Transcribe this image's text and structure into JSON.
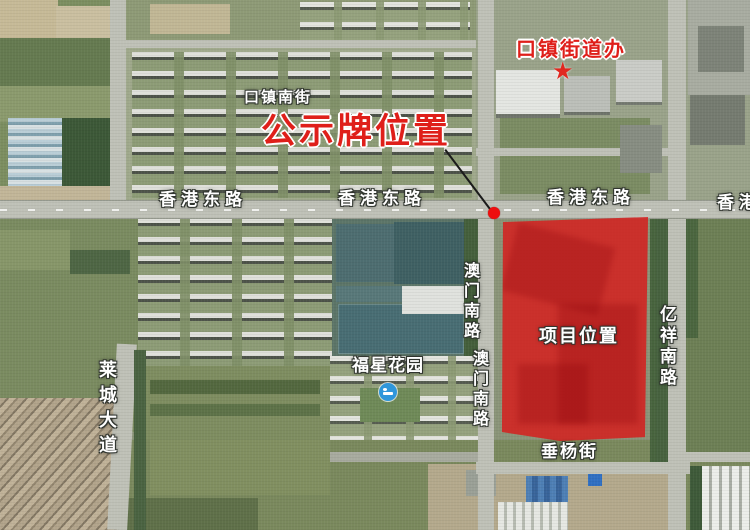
{
  "map": {
    "annotations": {
      "office": "口镇街道办",
      "notice_board": "公示牌位置",
      "project": "项目位置"
    },
    "streets": {
      "kouzhen_south": "口镇南街",
      "hk_east_left": "香港东路",
      "hk_east_center": "香港东路",
      "hk_east_right": "香港东路",
      "hk_east_edge": "香港",
      "aomen_south_upper": "澳门南路",
      "aomen_south_lower": "澳门南路",
      "yixiang_south": "亿祥南路",
      "laicheng_avenue": "莱城大道",
      "chuiyang": "垂杨街"
    },
    "places": {
      "fuxing_garden": "福星花园"
    },
    "icons": {
      "office_star": "★"
    },
    "colors": {
      "annotation_red": "#df1f1a",
      "project_overlay": "rgba(221,20,22,0.78)",
      "notice_dot": "#ee0f0f"
    }
  }
}
